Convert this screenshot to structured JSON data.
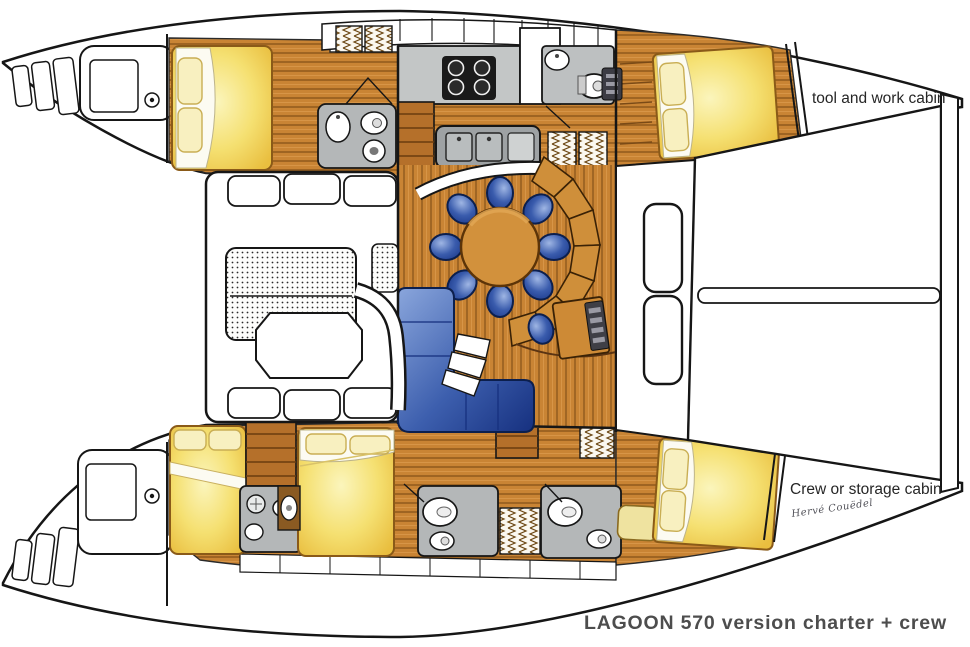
{
  "page": {
    "background": "#ffffff",
    "kind": "catamaran yacht floor-plan illustration"
  },
  "labels": {
    "tool_cabin": "tool and work cabin",
    "crew_cabin": "Crew  or storage cabin",
    "signature": "Hervé Couëdel",
    "caption": "LAGOON 570 version charter + crew"
  },
  "colors": {
    "outline": "#161616",
    "wood": "#C98434",
    "wood_stripe": "#8F5A1C",
    "wood_dark": "#A96A20",
    "bed_pale": "#FBF5BC",
    "bed_gold": "#E9BE3F",
    "upholstery_blue": "#4F74C0",
    "upholstery_blue_dark": "#1C3A8C",
    "counter_gray": "#B4B7B8",
    "counter_gray_dark": "#9EA2A4",
    "caption_gray": "#4D4D4D",
    "white": "#FFFFFF"
  },
  "plan_features": [
    "two hulls with pointed bows at right and stepped swim sterns at left",
    "central saloon with round dining table and eight blue chairs",
    "curved settee around table, blue L-shaped sofa, navigation desk",
    "galley with stove and twin sinks, multiple heads with toilets and basins",
    "five double berths in hulls, aft cockpit with octagonal table and sunpads",
    "forward deck with hatches, crossbeam and bow cabins"
  ]
}
